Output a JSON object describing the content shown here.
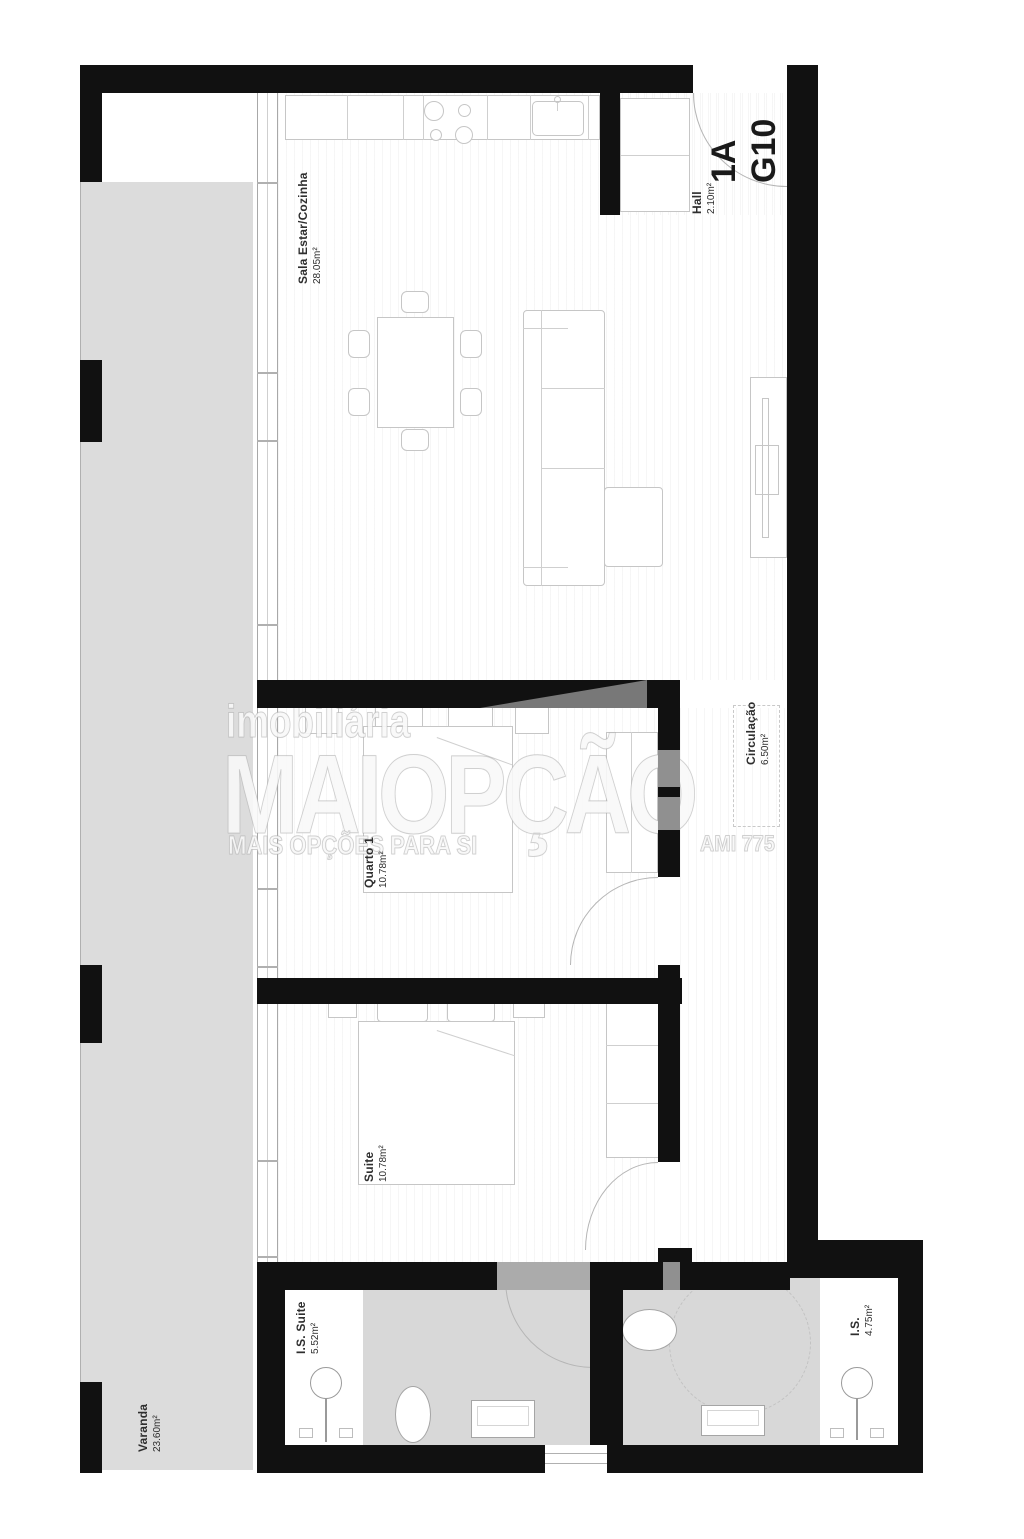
{
  "plan": {
    "unit": {
      "line1": "1A",
      "line2": "G10"
    },
    "rooms": [
      {
        "name": "Sala Estar/Cozinha",
        "area": "28.05m²"
      },
      {
        "name": "Hall",
        "area": "2.10m²"
      },
      {
        "name": "Varanda",
        "area": "23.60m²"
      },
      {
        "name": "Quarto 1",
        "area": "10.78m²"
      },
      {
        "name": "Circulação",
        "area": "6.50m²"
      },
      {
        "name": "Suite",
        "area": "10.78m²"
      },
      {
        "name": "I.S. Suite",
        "area": "5.52m²"
      },
      {
        "name": "I.S.",
        "area": "4.75m²"
      }
    ],
    "watermark": {
      "brand_top": "imobiliária",
      "brand_main": "MAIOPÇÃO",
      "tagline": "MAIS OPÇÕES PARA SI",
      "license": "AMI 775"
    },
    "colors": {
      "wall": "#111111",
      "terrace_floor": "#dcdcdc",
      "bath_floor": "#d8d8d8",
      "furniture_line": "#c6c6c6"
    }
  }
}
